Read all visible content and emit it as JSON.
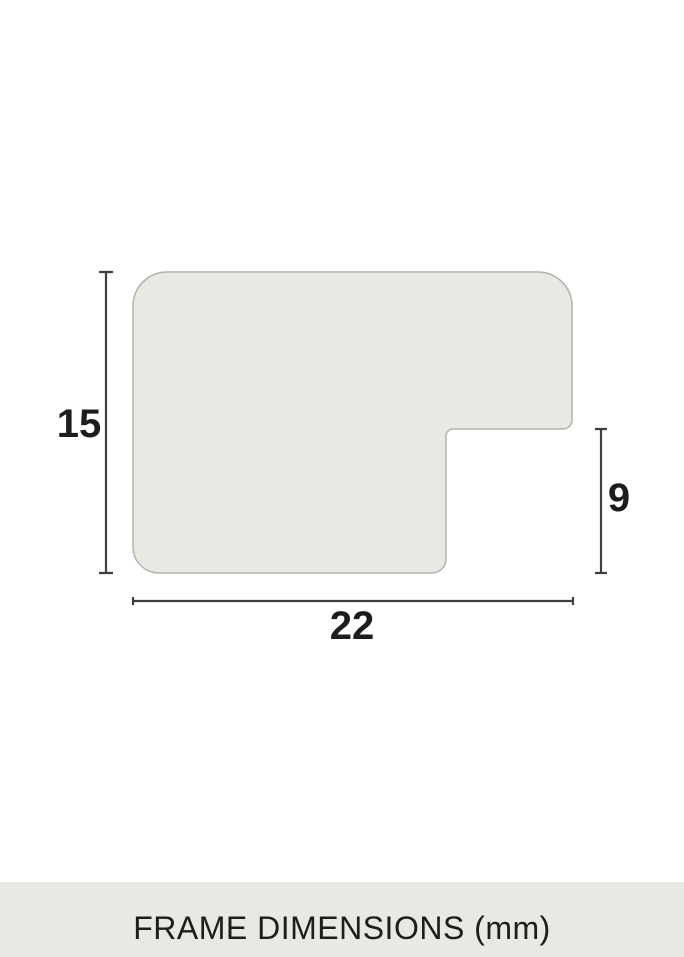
{
  "page": {
    "background": "#ffffff"
  },
  "diagram": {
    "profile": {
      "fill": "#e9e9e4",
      "stroke": "#b2b2ad"
    },
    "dimension_line_color": "#3f3f3f",
    "label_color": "#1d1d1b",
    "dimensions": {
      "height": "15",
      "depth": "9",
      "width": "22"
    }
  },
  "footer": {
    "label": "FRAME DIMENSIONS (mm)",
    "background": "#e9e9e4",
    "text_color": "#1d1d1b"
  }
}
